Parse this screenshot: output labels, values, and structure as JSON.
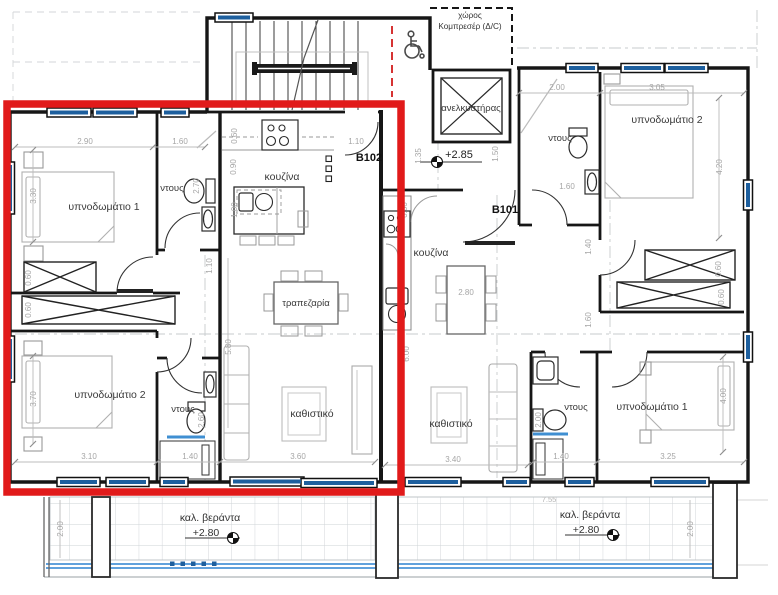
{
  "colors": {
    "highlight_red": "#e11a1a",
    "window_blue": "#1d5f9e",
    "veranda_blue": "#4a94d8"
  },
  "common": {
    "compressor_line1": "χώρος",
    "compressor_line2": "Κομπρεσέρ (Δ/C)",
    "elevator": "ανελκυστήρας",
    "lobby_level": "+2.85"
  },
  "b102": {
    "id": "B102",
    "bedroom1": "υπνοδωμάτιο 1",
    "bedroom2": "υπνοδωμάτιο 2",
    "shower_top": "ντους",
    "shower_bottom": "ντους",
    "kitchen": "κουζίνα",
    "dining": "τραπεζαρία",
    "living": "καθιστικό",
    "d_bedroom1_w": "2.90",
    "d_shower_top_w": "1.60",
    "d_bedroom1_h": "3.30",
    "d_k1": "0.60",
    "d_k2": "0.90",
    "d_k3": "1.00",
    "d_entry": "1.10",
    "d_hall": "1.10",
    "d_shower_top_h": "2.70",
    "d_w1": "0.60",
    "d_w2": "0.60",
    "d_dining_h": "5.80",
    "d_bedroom2_w": "3.10",
    "d_bedroom2_h": "3.70",
    "d_shower_bottom_w": "1.40",
    "d_shower_bottom_h": "2.60",
    "d_living_w": "3.60"
  },
  "b101": {
    "id": "B101",
    "bedroom1": "υπνοδωμάτιο 1",
    "bedroom2": "υπνοδωμάτιο 2",
    "shower_top": "ντους",
    "shower_bottom": "ντους",
    "kitchen": "κουζίνα",
    "living": "καθιστικό",
    "d_entry_l": "1.35",
    "d_entry_r": "1.50",
    "d_bath_top": "2.00",
    "d_bedroom2_w": "3.05",
    "d_bedroom2_h": "4.20",
    "d_bath_w": "1.60",
    "d_hall1": "1.40",
    "d_hall2": "1.60",
    "d_w1": "0.60",
    "d_w2": "0.60",
    "d_kitchen": "0.60",
    "d_dining_w": "2.80",
    "d_living_h": "6.00",
    "d_living_w": "3.40",
    "d_shower_bottom_w": "1.40",
    "d_shower_bottom_h": "2.00",
    "d_bedroom1_w": "3.25",
    "d_bedroom1_h": "4.00"
  },
  "veranda_left": {
    "label": "καλ. βεράντα",
    "level": "+2.80",
    "d_depth": "2.00"
  },
  "veranda_right": {
    "label": "καλ. βεράντα",
    "level": "+2.80",
    "d_depth": "2.00",
    "d_width": "7.55"
  }
}
